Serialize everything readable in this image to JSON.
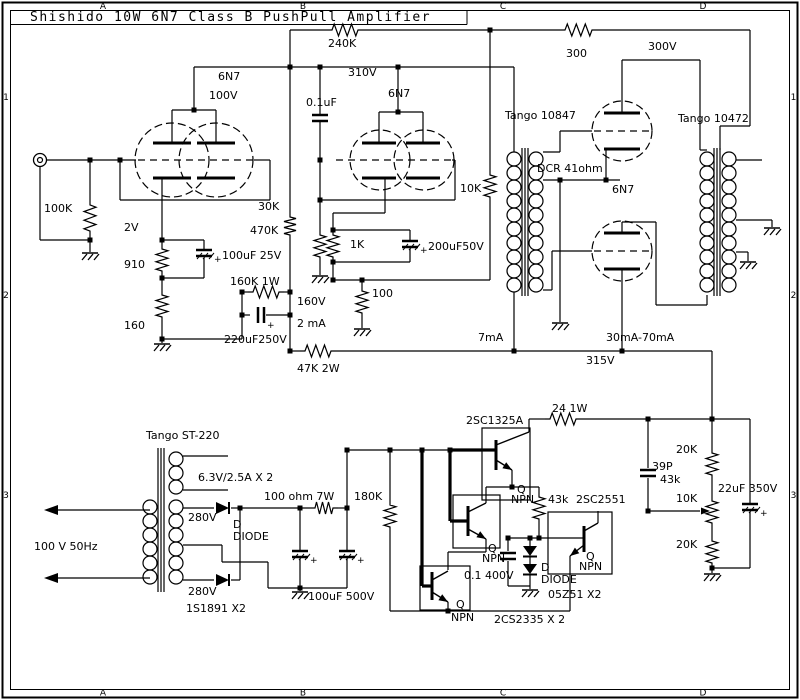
{
  "title": "Shishido 10W 6N7 Class B PushPull Amplifier",
  "grid": {
    "columns": [
      "A",
      "B",
      "C",
      "D"
    ],
    "column_x": [
      103,
      303,
      503,
      703
    ],
    "rows": [
      "1",
      "2",
      "3"
    ],
    "row_y": [
      100,
      298,
      498
    ],
    "top_y": 9,
    "bottom_y": 695.5,
    "left_x": 6,
    "right_x": 793.5
  },
  "colors": {
    "ink": "#000000",
    "paper": "#ffffff"
  },
  "labels": [
    {
      "t": "6N7",
      "x": 218,
      "y": 80
    },
    {
      "t": "100V",
      "x": 209,
      "y": 99
    },
    {
      "t": "240K",
      "x": 328,
      "y": 47
    },
    {
      "t": "310V",
      "x": 348,
      "y": 76
    },
    {
      "t": "6N7",
      "x": 388,
      "y": 97
    },
    {
      "t": "0.1uF",
      "x": 306,
      "y": 106
    },
    {
      "t": "300",
      "x": 566,
      "y": 57
    },
    {
      "t": "300V",
      "x": 648,
      "y": 50
    },
    {
      "t": "Tango 10847",
      "x": 505,
      "y": 119
    },
    {
      "t": "Tango 10472",
      "x": 678,
      "y": 122
    },
    {
      "t": "DCR 41ohm",
      "x": 537,
      "y": 172
    },
    {
      "t": "6N7",
      "x": 612,
      "y": 193
    },
    {
      "t": "10K",
      "x": 460,
      "y": 192
    },
    {
      "t": "100K",
      "x": 44,
      "y": 212
    },
    {
      "t": "2V",
      "x": 124,
      "y": 231
    },
    {
      "t": "910",
      "x": 124,
      "y": 268
    },
    {
      "t": "160",
      "x": 124,
      "y": 329
    },
    {
      "t": "100uF 25V",
      "x": 222,
      "y": 259
    },
    {
      "t": "160K 1W",
      "x": 230,
      "y": 285
    },
    {
      "t": "160V",
      "x": 297,
      "y": 305
    },
    {
      "t": "2 mA",
      "x": 297,
      "y": 327
    },
    {
      "t": "220uF250V",
      "x": 224,
      "y": 343
    },
    {
      "t": "30K",
      "x": 258,
      "y": 210
    },
    {
      "t": "470K",
      "x": 250,
      "y": 234
    },
    {
      "t": "1K",
      "x": 350,
      "y": 248
    },
    {
      "t": "200uF50V",
      "x": 428,
      "y": 250
    },
    {
      "t": "100",
      "x": 372,
      "y": 297
    },
    {
      "t": "47K 2W",
      "x": 297,
      "y": 372
    },
    {
      "t": "7mA",
      "x": 478,
      "y": 341
    },
    {
      "t": "30mA-70mA",
      "x": 606,
      "y": 341
    },
    {
      "t": "315V",
      "x": 586,
      "y": 364
    },
    {
      "t": "Tango ST-220",
      "x": 146,
      "y": 439
    },
    {
      "t": "6.3V/2.5A X 2",
      "x": 198,
      "y": 481
    },
    {
      "t": "100 ohm 7W",
      "x": 264,
      "y": 500
    },
    {
      "t": "180K",
      "x": 354,
      "y": 500
    },
    {
      "t": "100 V 50Hz",
      "x": 34,
      "y": 550
    },
    {
      "t": "280V",
      "x": 188,
      "y": 521
    },
    {
      "t": "280V",
      "x": 188,
      "y": 595
    },
    {
      "t": "D",
      "x": 233,
      "y": 528
    },
    {
      "t": "DIODE",
      "x": 233,
      "y": 540
    },
    {
      "t": "1S1891 X2",
      "x": 186,
      "y": 612
    },
    {
      "t": "100uF 500V",
      "x": 308,
      "y": 600
    },
    {
      "t": "2SC1325A",
      "x": 466,
      "y": 424
    },
    {
      "t": "24 1W",
      "x": 552,
      "y": 412
    },
    {
      "t": "Q",
      "x": 517,
      "y": 493
    },
    {
      "t": "NPN",
      "x": 511,
      "y": 503
    },
    {
      "t": "43k",
      "x": 548,
      "y": 503
    },
    {
      "t": "2SC2551",
      "x": 576,
      "y": 503
    },
    {
      "t": "39P",
      "x": 652,
      "y": 470
    },
    {
      "t": "43k",
      "x": 660,
      "y": 483
    },
    {
      "t": "20K",
      "x": 676,
      "y": 453
    },
    {
      "t": "10K",
      "x": 676,
      "y": 502
    },
    {
      "t": "20K",
      "x": 676,
      "y": 548
    },
    {
      "t": "22uF 350V",
      "x": 718,
      "y": 492
    },
    {
      "t": "Q",
      "x": 488,
      "y": 552
    },
    {
      "t": "NPN",
      "x": 482,
      "y": 562
    },
    {
      "t": "Q",
      "x": 456,
      "y": 608
    },
    {
      "t": "NPN",
      "x": 451,
      "y": 621
    },
    {
      "t": "0.1 400V",
      "x": 464,
      "y": 579
    },
    {
      "t": "D",
      "x": 541,
      "y": 571
    },
    {
      "t": "DIODE",
      "x": 541,
      "y": 583
    },
    {
      "t": "05Z51 X2",
      "x": 548,
      "y": 598
    },
    {
      "t": "2CS2335 X 2",
      "x": 494,
      "y": 623
    },
    {
      "t": "Q",
      "x": 586,
      "y": 560
    },
    {
      "t": "NPN",
      "x": 579,
      "y": 570
    }
  ]
}
